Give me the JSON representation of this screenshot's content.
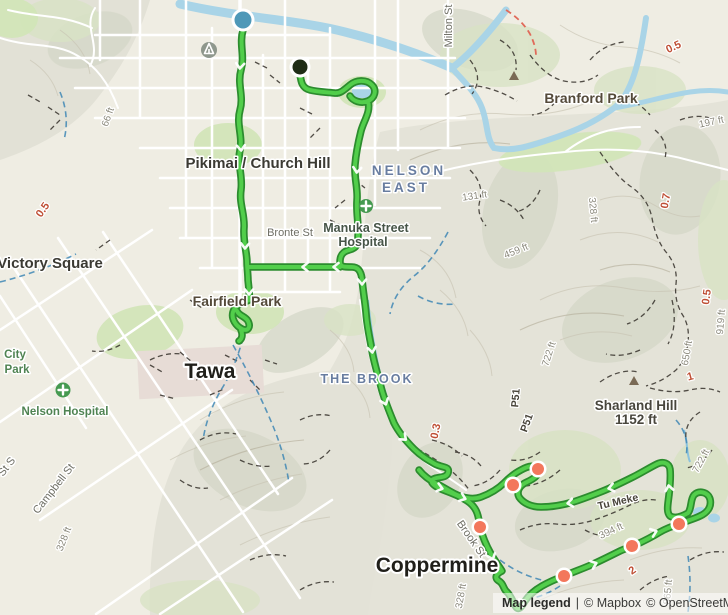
{
  "attribution": {
    "legend_link": "Map legend",
    "divider": "|",
    "mapbox": "© Mapbox",
    "osm": "© OpenStreetMap"
  },
  "colors": {
    "route_core": "#52ce4b",
    "route_casing": "#2c8c2e",
    "start_marker": "#4e98b8",
    "end_marker": "#1f2d17",
    "waypoint": "#f3775c",
    "water": "#a9d4e7",
    "suburb_text": "#687da0",
    "distance_text": "#bf4f35"
  },
  "labels": {
    "places": [
      "Pikimai / Church Hill",
      "Victory Square",
      "Tawa",
      "Coppermine"
    ],
    "suburbs": [
      "NELSON",
      "EAST",
      "THE BROOK"
    ],
    "parks": [
      "Branford Park",
      "Fairfield Park",
      "City",
      "Park"
    ],
    "hospitals": [
      "Manuka Street",
      "Hospital",
      "Nelson Hospital"
    ],
    "streets": [
      "Milton St",
      "Bronte St",
      "Campbell St",
      "St S",
      "Brook St"
    ],
    "elevations": [
      "66 ft",
      "131 ft",
      "197 ft",
      "328 ft",
      "459 ft",
      "722 ft",
      "328 ft",
      "394 ft",
      "722 ft",
      "919 ft",
      "650 ft",
      "328 ft",
      "865 ft"
    ],
    "distances": [
      "0.5",
      "0.5",
      "0.7",
      "0.3",
      "0.5",
      "1",
      "2"
    ],
    "trails": [
      "P51",
      "P51",
      "Tu Meke"
    ],
    "peak": {
      "name": "Sharland Hill",
      "elevation": "1152 ft"
    }
  }
}
